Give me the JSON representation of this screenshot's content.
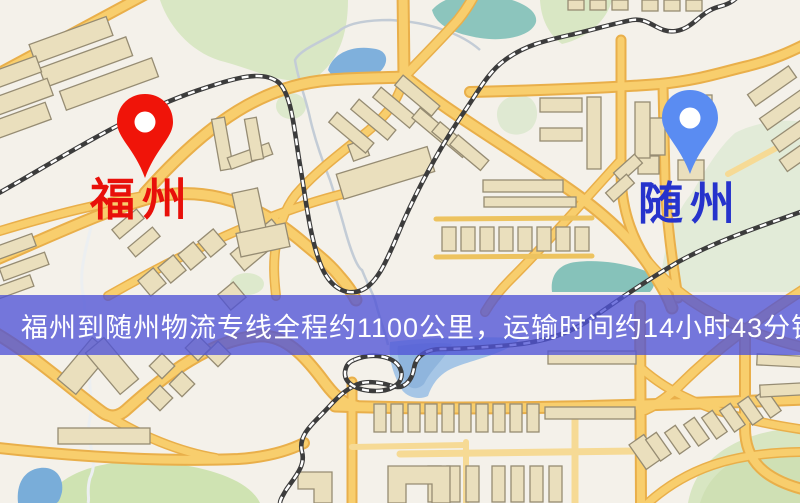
{
  "map": {
    "origin": {
      "label": "福州",
      "pin_color": "#f01409",
      "label_color": "#e8100a"
    },
    "destination": {
      "label": "随州",
      "pin_color": "#5a8cf2",
      "label_color": "#2633cc"
    },
    "banner": {
      "text": "福州到随州物流专线全程约1100公里，运输时间约14小时43分钟.",
      "distance_text": "约1100公里",
      "duration_text": "约14小时43分钟",
      "background_color": "#4f53d6",
      "text_color": "#ffffff"
    },
    "palette": {
      "map_background": "#f4f1ea",
      "road_fill": "#f8ce6d",
      "road_casing": "#e9af4a",
      "building_fill": "#eadfbd",
      "park_green": "#d9e7c4",
      "water_blue": "#7fb0dc",
      "pond_teal": "#8cc5bd",
      "railway_dark": "#3c3c3c"
    }
  }
}
